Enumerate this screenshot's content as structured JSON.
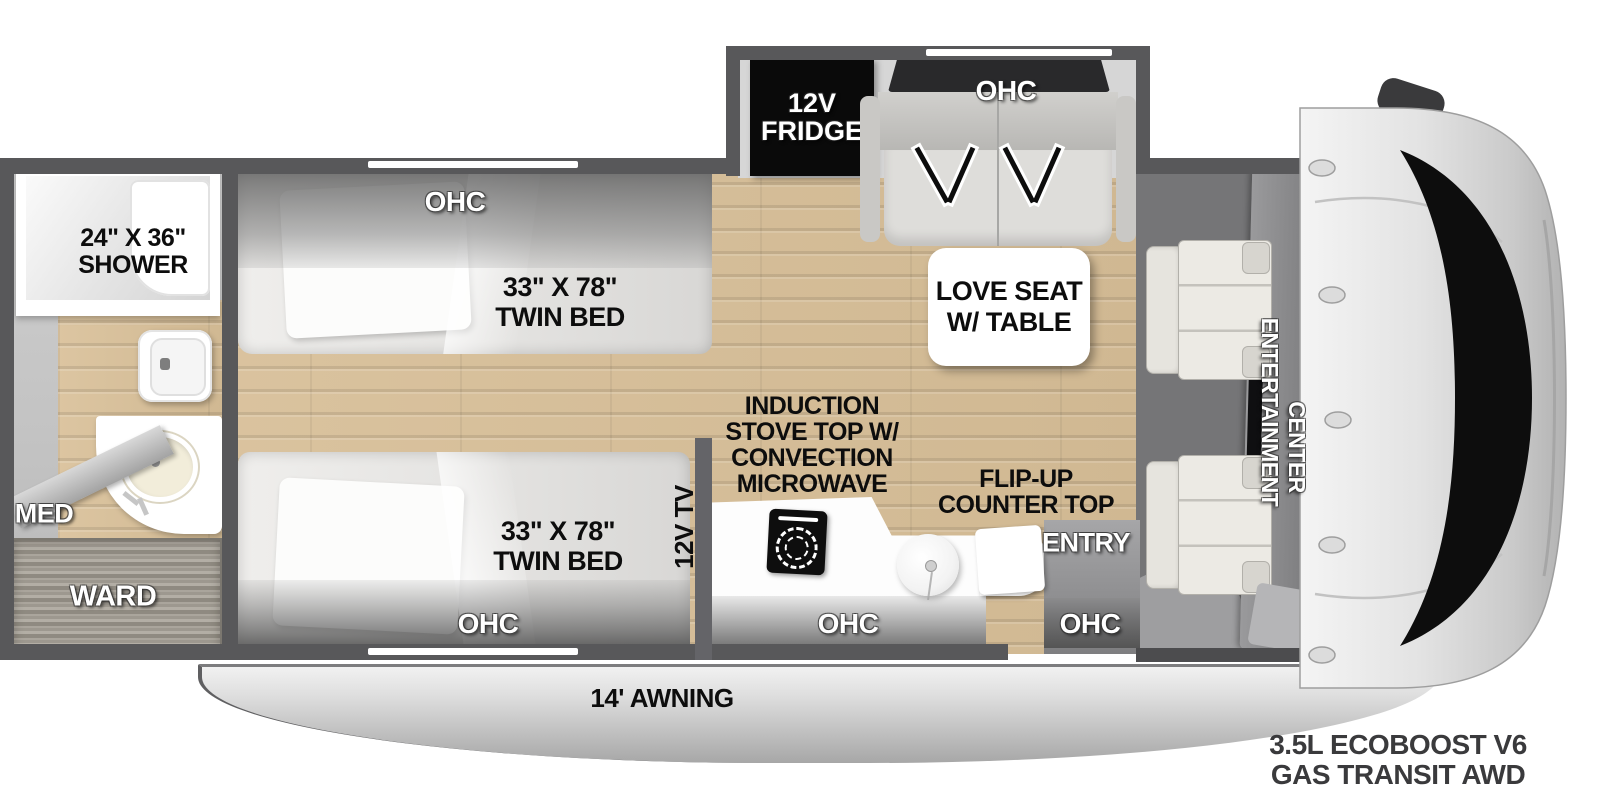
{
  "labels": {
    "ohc": "OHC",
    "shower_l1": "24\" X 36\"",
    "shower_l2": "SHOWER",
    "med": "MED",
    "ward": "WARD",
    "twin_l1": "33\" X 78\"",
    "twin_l2": "TWIN BED",
    "tv": "12V TV",
    "fridge_l1": "12V",
    "fridge_l2": "FRIDGE",
    "loveseat_l1": "LOVE SEAT",
    "loveseat_l2": "W/ TABLE",
    "stove_l1": "INDUCTION",
    "stove_l2": "STOVE TOP W/",
    "stove_l3": "CONVECTION",
    "stove_l4": "MICROWAVE",
    "flip_l1": "FLIP-UP",
    "flip_l2": "COUNTER TOP",
    "entry": "ENTRY",
    "ec_l1": "ENTERTAINMENT",
    "ec_l2": "CENTER",
    "awning": "14' AWNING",
    "chassis_l1": "3.5L ECOBOOST V6",
    "chassis_l2": "GAS TRANSIT AWD"
  },
  "colors": {
    "wall": "#58585a",
    "floor_wood": "#d9c29d",
    "fridge": "#0a0a0a",
    "counter": "#fdfdfd",
    "awning": "#c7c7c7",
    "cab_body": "#d9d9d9",
    "windshield": "#0d0d0d"
  }
}
